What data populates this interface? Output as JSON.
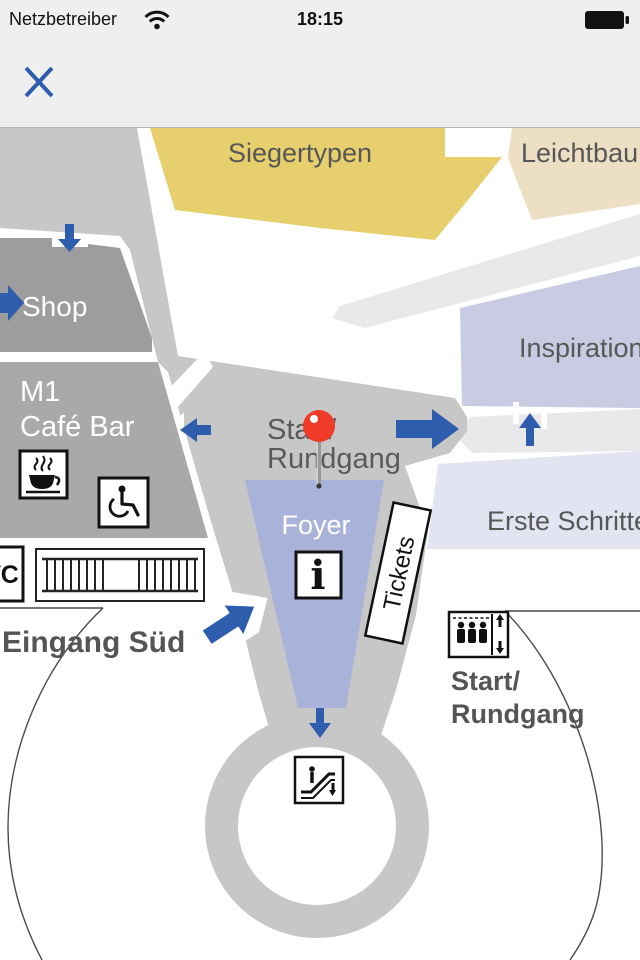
{
  "status_bar": {
    "carrier": "Netzbetreiber",
    "time": "18:15"
  },
  "toolbar": {
    "close_icon": "close"
  },
  "map": {
    "colors": {
      "corridor": "#c7c7c8",
      "shop": "#9d9d9d",
      "cafe_block": "#a9a9a9",
      "siegertypen": "#e8cf6d",
      "leichtbau": "#ecdfc3",
      "inspiration": "#c8cbe2",
      "erste_schritte": "#e2e4f2",
      "foyer": "#a9b2d9",
      "walkway": "#e9e9ec",
      "arrow_blue": "#2d5dac",
      "pin_red": "#f03b28",
      "label_gray": "#575757"
    },
    "areas": {
      "siegertypen": "Siegertypen",
      "leichtbau": "Leichtbau",
      "shop": "Shop",
      "cafe_line1": "M1",
      "cafe_line2": "Café Bar",
      "inspiration": "Inspiration",
      "erste_schritte": "Erste Schritte",
      "foyer": "Foyer"
    },
    "labels": {
      "start_center_line1": "Start/",
      "start_center_line2": "Rundgang",
      "start_right_line1": "Start/",
      "start_right_line2": "Rundgang",
      "eingang_sued": "Eingang Süd",
      "tickets": "Tickets",
      "wc": "WC",
      "info": "i"
    },
    "icons": [
      "close-icon",
      "wifi-icon",
      "battery-icon",
      "map-pin",
      "info-icon",
      "coffee-icon",
      "wheelchair-icon",
      "stairs-icon",
      "elevator-icon",
      "escalator-icon",
      "arrow-right-icon",
      "arrow-left-icon",
      "arrow-up-icon",
      "arrow-down-icon",
      "arrow-up-right-icon",
      "tickets-sign"
    ]
  }
}
